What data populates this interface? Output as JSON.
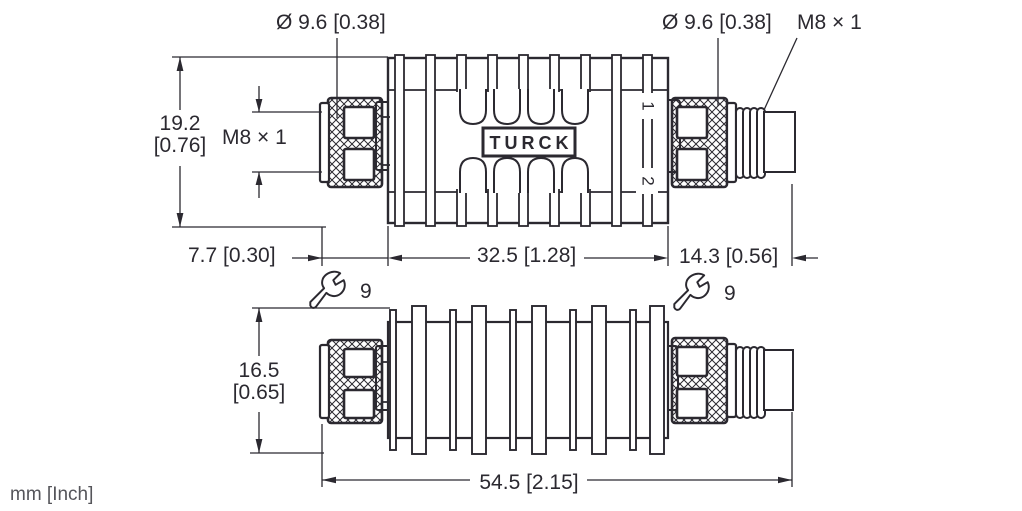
{
  "drawing": {
    "units_label": "mm [Inch]",
    "brand": "TURCK",
    "top_view": {
      "diameter_left": "Ø 9.6 [0.38]",
      "diameter_right": "Ø 9.6 [0.38]",
      "thread_left": "M8 × 1",
      "thread_right": "M8 × 1",
      "height_mm": "19.2",
      "height_inch": "[0.76]",
      "length_left": "7.7 [0.30]",
      "length_body": "32.5 [1.28]",
      "length_right": "14.3 [0.56]",
      "pin_1": "1",
      "pin_2": "2"
    },
    "bottom_view": {
      "height_mm": "16.5",
      "height_inch": "[0.65]",
      "length_total": "54.5 [2.15]"
    },
    "wrench_left_size": "9",
    "wrench_right_size": "9"
  }
}
